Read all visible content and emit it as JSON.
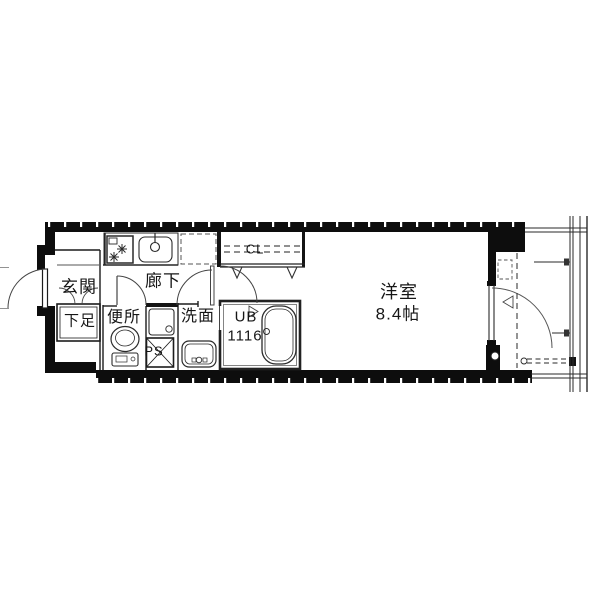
{
  "plan": {
    "type": "apartment-floorplan",
    "rooms": {
      "genkan": {
        "label": "玄関"
      },
      "shoe_storage": {
        "label": "下足"
      },
      "hallway": {
        "label": "廊下"
      },
      "toilet": {
        "label": "便所"
      },
      "pipe_space": {
        "label": "PS"
      },
      "washroom": {
        "label": "洗面"
      },
      "unit_bath": {
        "label_line1": "UB",
        "label_line2": "1116"
      },
      "closet": {
        "label": "CL"
      },
      "western_room": {
        "label": "洋室",
        "size": "8.4帖"
      }
    },
    "colors": {
      "wall": "#0d0d0d",
      "line": "#2a2a2a",
      "background": "#ffffff"
    }
  }
}
